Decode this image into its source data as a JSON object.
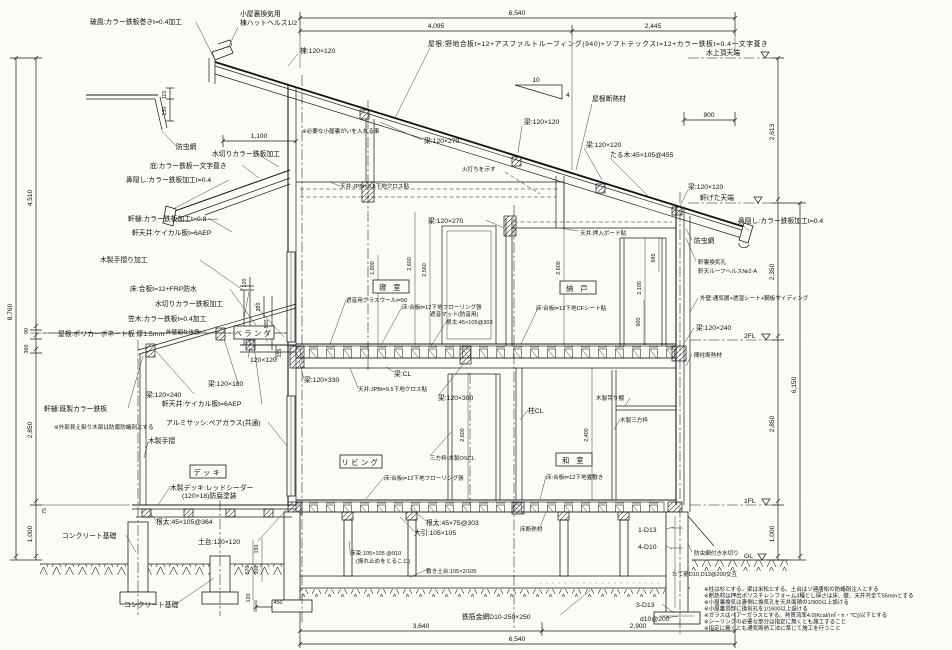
{
  "labels": {
    "hafu": "破風:カラー鉄板巻きt=0.4加工",
    "koyaura_vent_1": "小屋裏換気用",
    "koyaura_vent_2": "棟ハットヘルス1/2",
    "mune": "棟:120×120",
    "roof_spec": "屋根:野地合板t=12+アスファルトルーフィング(940)+ソフトテックスt=12+カラー鉄板t=0.4一文字葺き",
    "attic_note": "※必要な小屋裏がいを入れる事",
    "roof_insulation": "屋根断熱材",
    "beam_120x270": "梁:120×270",
    "beam_120x120": "梁:120×120",
    "taruki": "たる木:45×105@455",
    "hiuchi": "火打ちを示す",
    "ceiling_jpb": "天井:JPBt=9.5下地クロス貼",
    "ceiling_nando": "天井:押入ボード貼",
    "bochumou": "防虫網",
    "mizukiri_color": "水切りカラー鉄板加工",
    "hisashi_color": "庇:カラー鉄板一文字葺き",
    "hanakakushi": "鼻隠し:カラー鉄板加工t=0.4",
    "nokitoi_08": "軒樋:カラー鉄板加工t=0.8",
    "nokitenjo": "軒天井:ケイカル板t=6AEP",
    "tesuri_kakou": "木製手摺り加工",
    "balcony_floor": "床:合板t=12+FRP防水",
    "kasagi": "笠木:カラー鉄板t=0.4加工",
    "gaiheki_note": "外壁廻り注意",
    "polycarb": "屋根:ポリカーボネート板 厚1.5mm",
    "p120": "120×120",
    "beam_120x180": "梁:120×180",
    "beam_120x240": "梁:120×240",
    "nokitoi_kisei": "軒樋:既製カラー鉄板",
    "ext_wood_note": "※外部見え掛り木部は防腐防蟻剤とする",
    "tesuri": "木製手摺",
    "sash": "アルミサッシ:ペアガラス(共通)",
    "deck_spec_1": "木製デッキ:レッドシーダー",
    "deck_spec_2": "(120×18)防腐塗装",
    "concrete": "コンクリート基礎",
    "neda_364": "根太:45×105@364",
    "dodai": "土台:120×120",
    "gw_50": "遮音用グラスウールt=50",
    "floor_2f_1": "床:合板t=12下地フローリング張",
    "floor_2f_2": "遮音マット(防音用)",
    "neda_303": "根太:45×105@303",
    "floor_cf": "床:合板t=12下地CFシート貼",
    "nokiura_1": "軒裏換気孔",
    "nokiura_2": "軒天ルーフヘルス№2-A",
    "gaiheki": "外壁:通気層+透湿シート+鋼板サイディング",
    "mabashira_ins": "間柱断熱材",
    "beam_cl": "梁:CL",
    "beam_120x330": "梁:120×330",
    "beam_120x300": "梁:120×300",
    "hashira_cl": "柱CL",
    "sanpo_oscl": "三方枠:木製OSCL",
    "tatami_floor": "床:合板t=12下地畳敷き",
    "tsuridana": "木製吊り棚",
    "sanpo_wood": "木製三方枠",
    "floor_ins": "床断熱材",
    "neda_4575": "根太:45×75@303",
    "ohiki": "大引:105×105",
    "yukazuka_1": "床束:105×105 @910",
    "yukazuka_2": "(振れ止めをとること)",
    "shikidodai": "敷き土台:105×2/105",
    "mesh": "鉄筋金網D10-250×250",
    "r_1d13": "1-D13",
    "r_4d10": "4-D10",
    "r_3d13": "3-D13",
    "r_d10": "d10@200",
    "mizukiri_mushi": "防虫網付き水切り",
    "tatekin": "たて筋D10,D13@200交互"
  },
  "rooms": {
    "veranda": "ベランダ",
    "bedroom": "寝 室",
    "nando": "納 戸",
    "living": "リビング",
    "washitsu": "和 室",
    "deck": "デッキ"
  },
  "levels": {
    "mizukami": "水上頂天端",
    "nokigeta": "軒げた天端",
    "fl2": "2FL",
    "fl1": "1FL",
    "gl": "GL"
  },
  "dims": {
    "t6540": "6,540",
    "t4095": "4,095",
    "t2445": "2,445",
    "r900": "900",
    "r2613": "2,613",
    "r2350": "2,350",
    "r6150": "6,150",
    "r2850": "2,850",
    "r1000": "1,000",
    "l8760": "8,760",
    "l4510": "4,510",
    "l90": "90",
    "l360": "360",
    "l75": "75",
    "c1100": "1,100",
    "c115": "115",
    "c230": "230",
    "b120": "120",
    "b320": "320",
    "b800": "800",
    "b155": "155",
    "h1800": "1,800",
    "h2650": "2,650",
    "h2560": "2,560",
    "h2600": "2,600",
    "n2100": "2,100",
    "n685": "685",
    "n900": "900",
    "w2400": "2,400",
    "f570": "570",
    "f150": "150",
    "f300": "300",
    "f120": "120",
    "f450": "450",
    "g3640": "3,640",
    "g2900": "2,900",
    "slope10": "10",
    "slope4": "4"
  },
  "notes": [
    "※柱は杉とする。梁は米松とする。土台はソ連唐松の防蟻剤注入とする",
    "※断熱材は押出ポリスチレンフォーム3種とし厚さは床、壁、天井共全て55mmとする",
    "※小屋裏換気は妻側に換気孔を天井面積の1/900以上設ける",
    "※小屋裏頂部に換気孔を1/1600以上設ける",
    "※ガラスはペアーガラスとする。熱貫流率4.0(Kcal/(㎡・h・℃))以下とする",
    "※シーリングの必要な部分は指定に無くとも施工すること",
    "※指定に無くとも通気断熱工法に準じて施工を行うこと"
  ]
}
